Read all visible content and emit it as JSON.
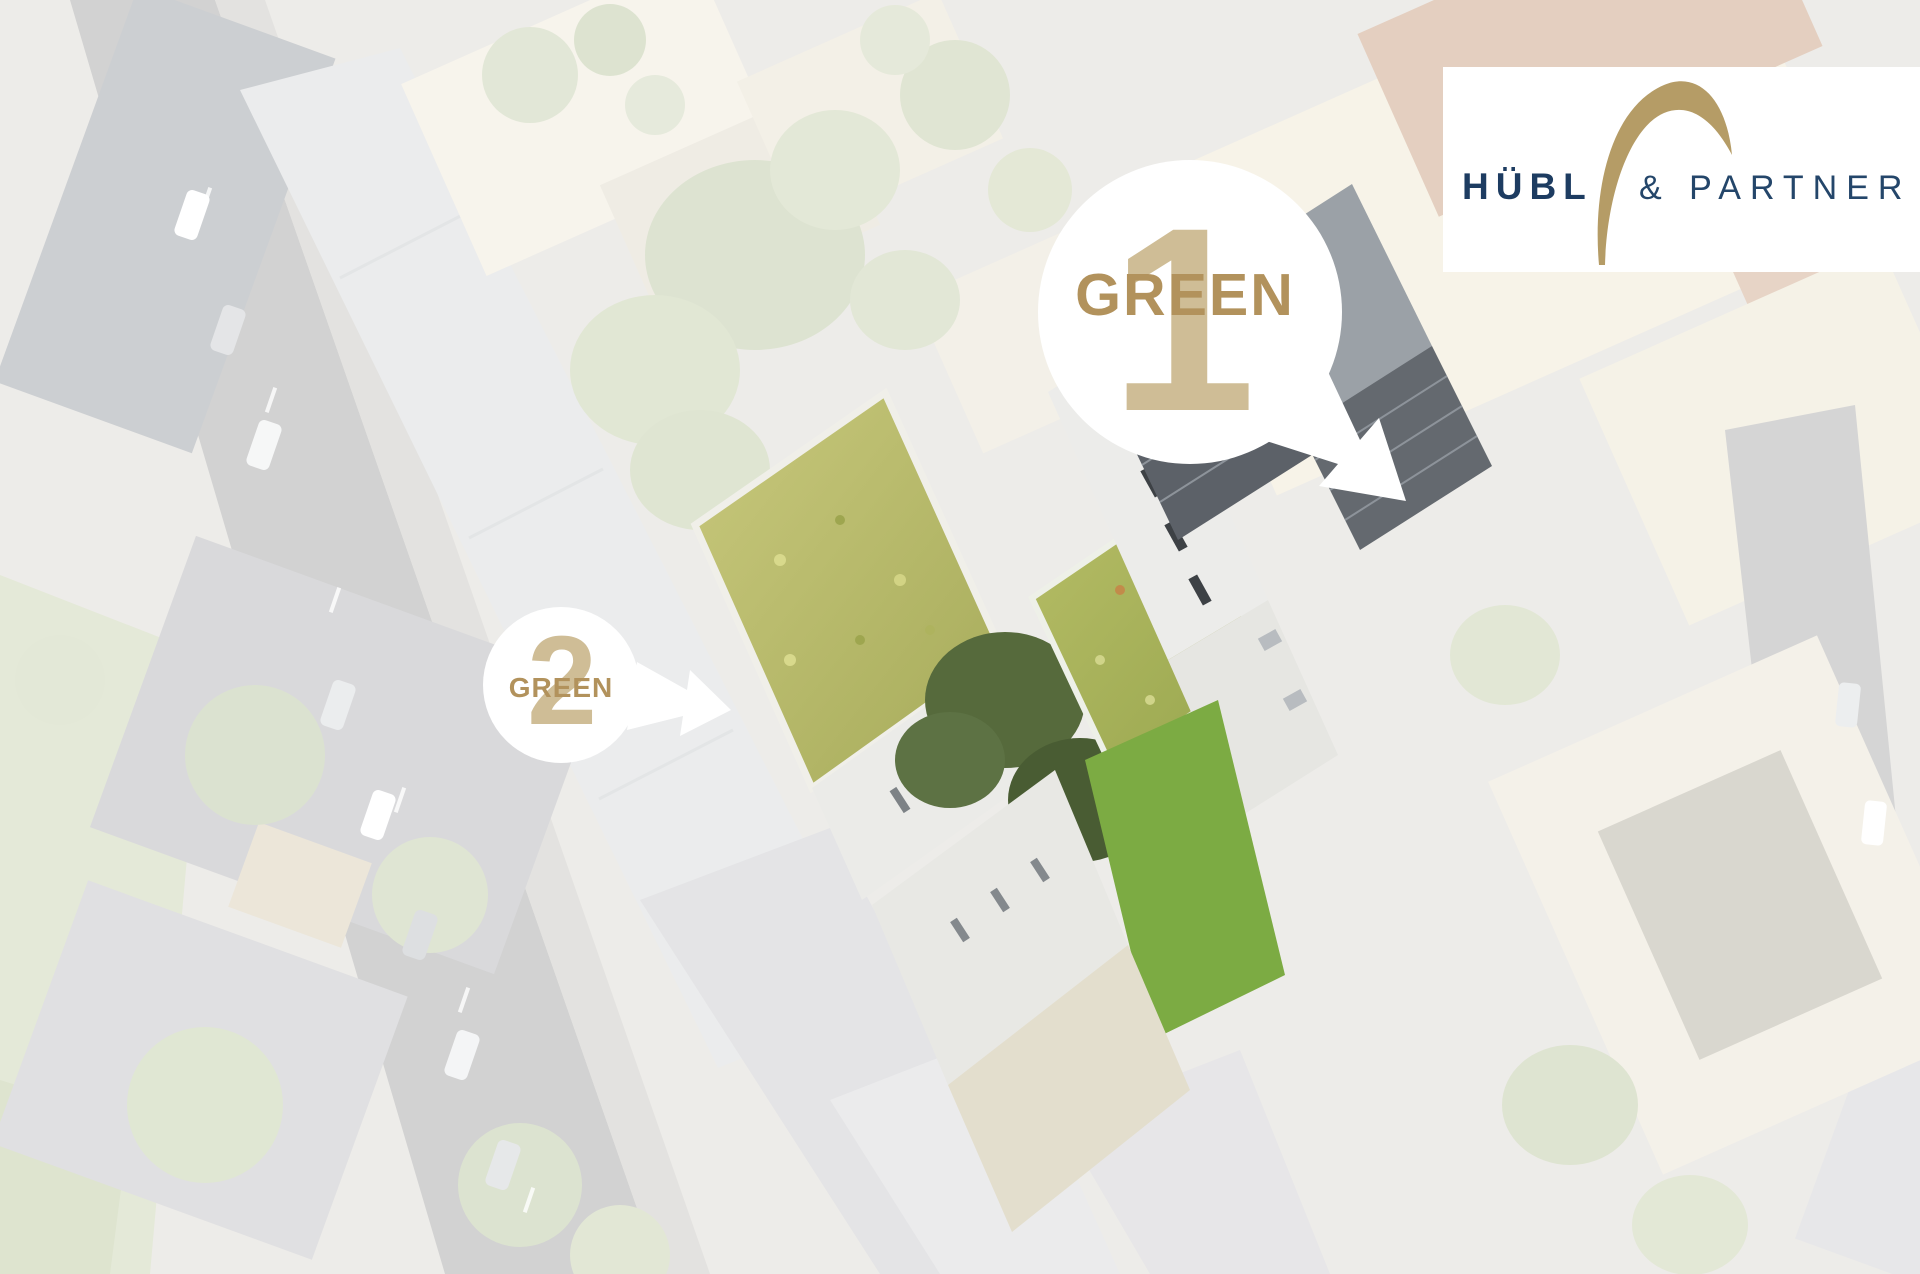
{
  "brand": {
    "logo_primary": "HÜBL",
    "logo_secondary": "& PARTNER",
    "logo_arc_icon": "gold-arc-swoosh",
    "colors": {
      "navy": "#1d3c61",
      "gold": "#b59c66",
      "background": "#ffffff"
    }
  },
  "callouts": {
    "green1": {
      "label": "GREEN",
      "number": "1"
    },
    "green2": {
      "label": "GREEN",
      "number": "2"
    },
    "colors": {
      "label_gold": "#b2925c",
      "number_beige": "#cfbd96",
      "bubble": "#ffffff"
    }
  },
  "photo": {
    "subject": "aerial view of city block with highlighted green-roof development",
    "colors": {
      "sedum_roof": "#b9ba6a",
      "second_green_roof": "#a8b35b",
      "lawn": "#7cab43",
      "courtyard_trees": "#4f6238",
      "solar_panels": "#5c6168",
      "faded_wash": "#ffffff"
    }
  }
}
